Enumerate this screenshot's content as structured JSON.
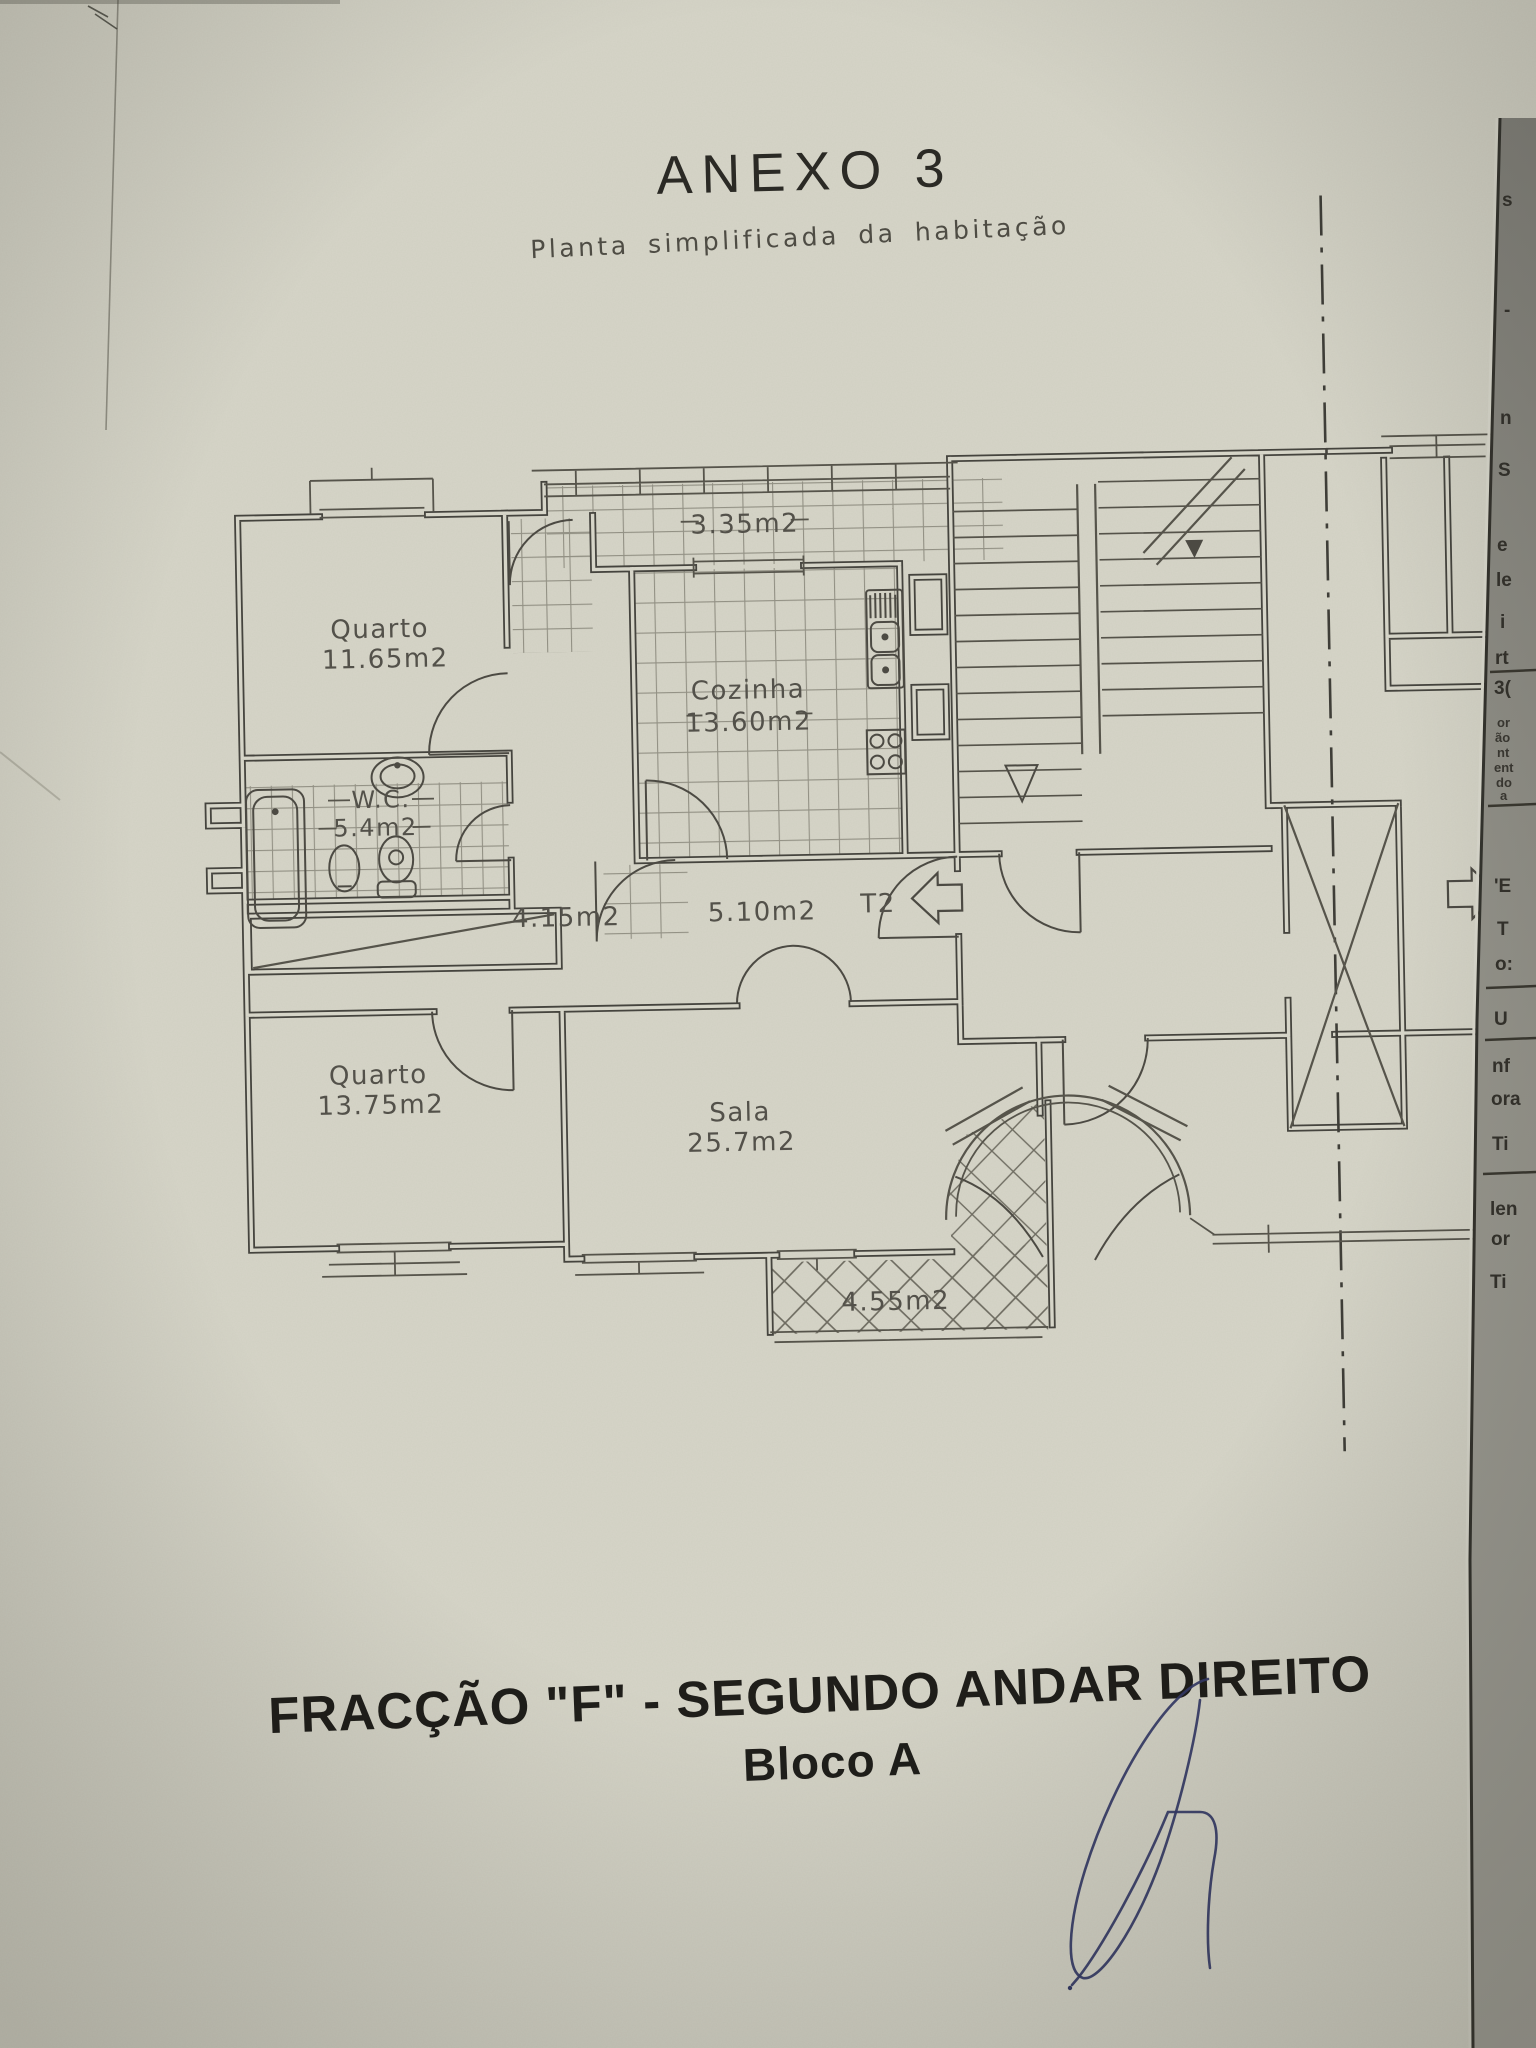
{
  "document": {
    "title": "ANEXO 3",
    "subtitle": "Planta simplificada da habitação",
    "caption_line1": "FRACÇÃO  \"F\" - SEGUNDO ANDAR DIREITO",
    "caption_line2": "Bloco A"
  },
  "plan": {
    "unit_label": "T2",
    "rooms": [
      {
        "name": "Quarto",
        "area": "11.65m2"
      },
      {
        "name": "Cozinha",
        "area": "13.60m2"
      },
      {
        "name": "W.C.",
        "area": "5.4m2"
      },
      {
        "name": "Quarto",
        "area": "13.75m2"
      },
      {
        "name": "Sala",
        "area": "25.7m2"
      }
    ],
    "areas": [
      {
        "label": "3.35m2"
      },
      {
        "label": "4.15m2"
      },
      {
        "label": "5.10m2"
      },
      {
        "label": "4.55m2"
      }
    ]
  },
  "edge_fragments": [
    "s",
    "-",
    "n",
    "S",
    "e",
    "le",
    "i",
    "rt",
    "3(",
    "or",
    "ão",
    "nt",
    "ent",
    "do",
    "a",
    "'E",
    "T",
    "o:",
    "U",
    "nf",
    "ora",
    "Ti",
    "len",
    "or",
    "Ti"
  ],
  "colors": {
    "paper": "#d6d5c8",
    "ink": "#2c2b26",
    "pencil": "#55534a",
    "signature_blue": "#343a66",
    "under_page": "#8f8e85"
  }
}
